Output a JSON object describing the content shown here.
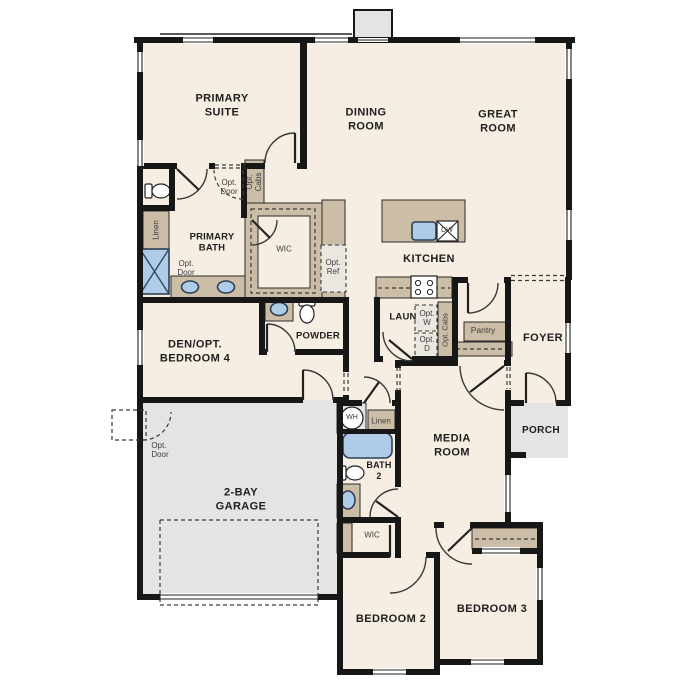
{
  "labels": {
    "primary_suite": "PRIMARY\nSUITE",
    "dining_room": "DINING\nROOM",
    "great_room": "GREAT\nROOM",
    "primary_bath": "PRIMARY\nBATH",
    "linen_primary": "Linen",
    "opt_door_bath_entry": "Opt.\nDoor",
    "opt_cabs_dining": "Opt.\nCabs",
    "wic_primary": "WIC",
    "opt_ref": "Opt.\nRef",
    "kitchen": "KITCHEN",
    "dishwasher": "DW",
    "opt_door_shower": "Opt.\nDoor",
    "den": "DEN/OPT.\nBEDROOM 4",
    "powder": "POWDER",
    "laundry": "LAUN",
    "opt_washer": "Opt.\nW",
    "opt_dryer": "Opt.\nD",
    "opt_cabs_laundry": "Opt. Cabs",
    "pantry": "Pantry",
    "foyer": "FOYER",
    "porch": "PORCH",
    "opt_door_garage": "Opt.\nDoor",
    "garage": "2-BAY\nGARAGE",
    "water_heater": "WH",
    "linen_bath2": "Linen",
    "bath2": "BATH\n2",
    "media_room": "MEDIA\nROOM",
    "wic_bed2": "WIC",
    "bedroom2": "BEDROOM 2",
    "bedroom3": "BEDROOM 3"
  },
  "colors": {
    "floor": "#f6eee2",
    "wall": "#171717",
    "cabinet": "#ccbda7",
    "fixture_blue": "#aecbe7",
    "garage_floor": "#e4e4e2",
    "porch_floor": "#e1e1df",
    "label": "#1e1e1e"
  }
}
